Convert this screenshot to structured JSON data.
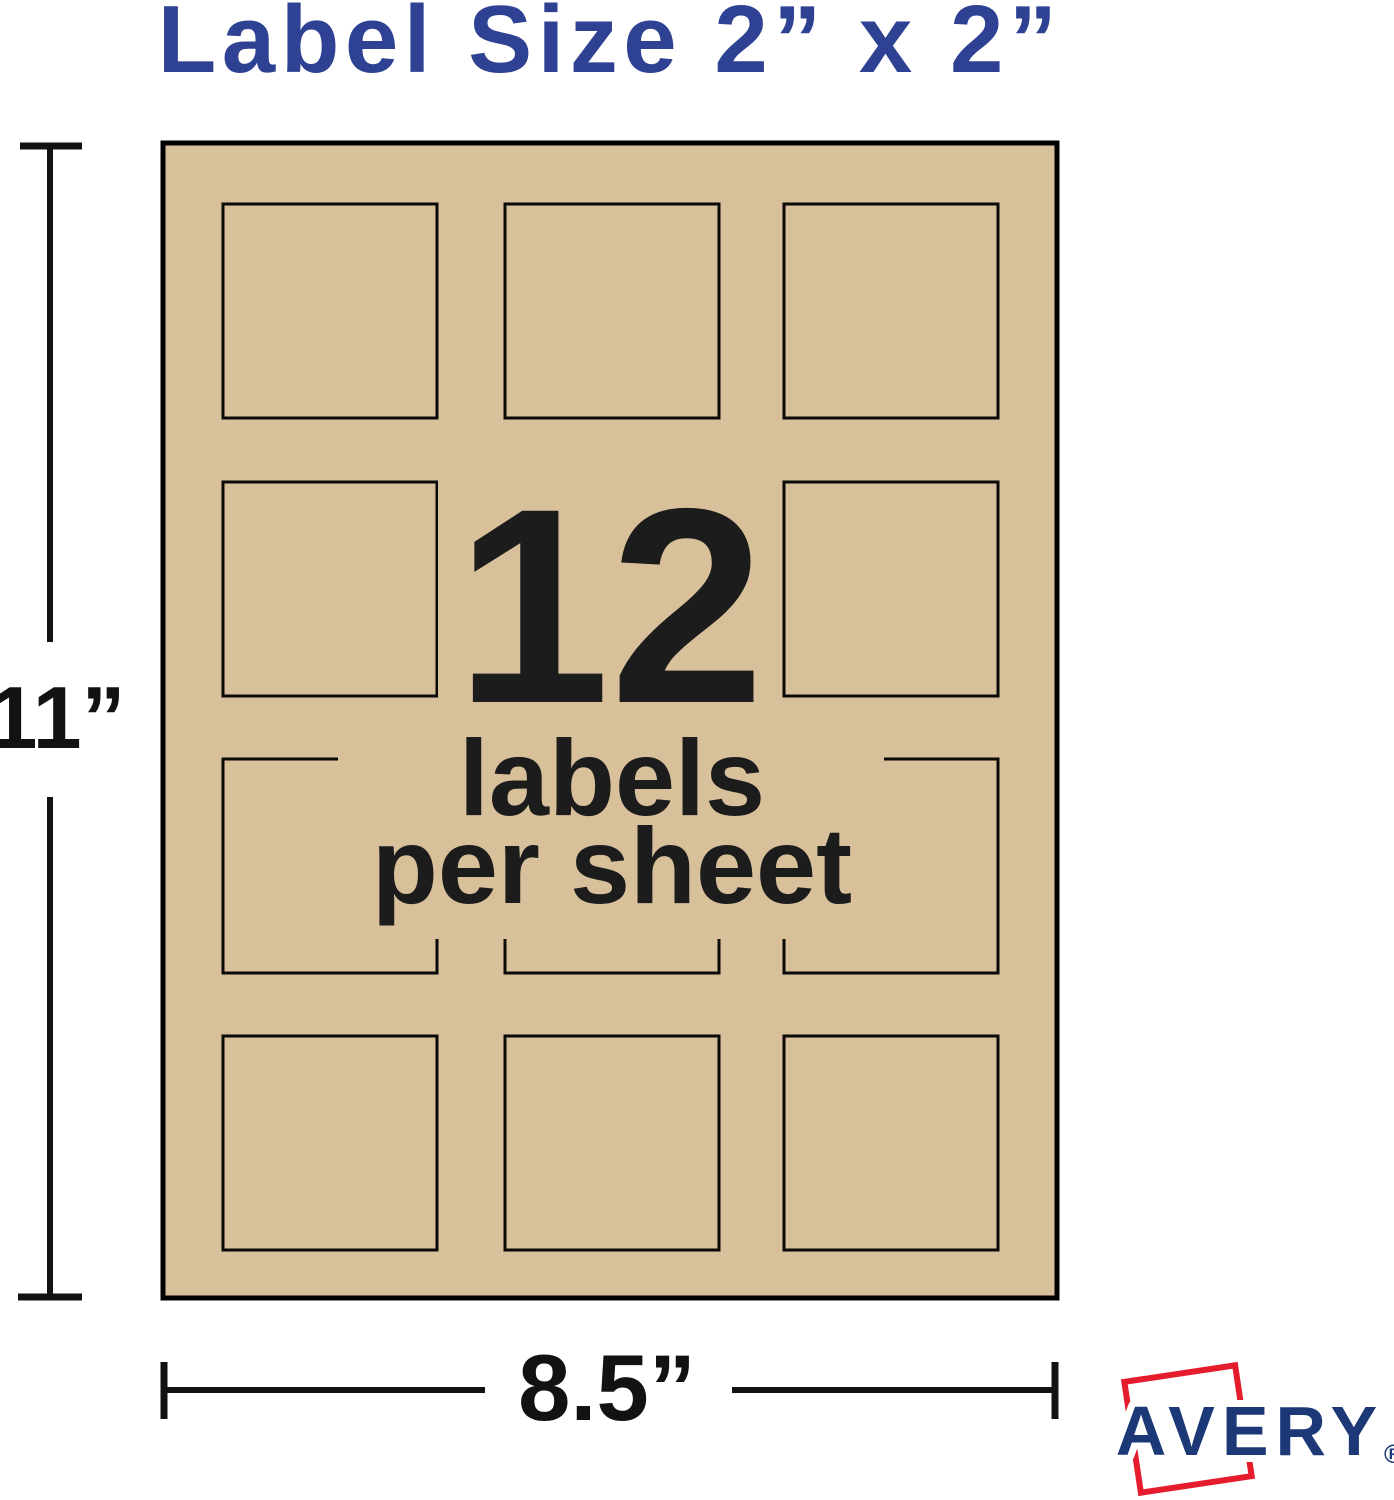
{
  "title": {
    "text": "Label Size 2” x 2”",
    "color": "#2e4193"
  },
  "sheet": {
    "fill_color": "#d8c09a",
    "border_color": "#000000",
    "grid": {
      "rows": 4,
      "cols": 3,
      "total_labels": 12
    }
  },
  "center": {
    "count": "12",
    "line1": "labels",
    "line2": "per sheet",
    "text_color": "#1c1c1c"
  },
  "dims": {
    "height": "11”",
    "width": "8.5”",
    "line_color": "#121212"
  },
  "logo": {
    "brand": "AVERY",
    "registered": "®",
    "frame_color": "#e51c2c",
    "text_color": "#1c3877"
  }
}
